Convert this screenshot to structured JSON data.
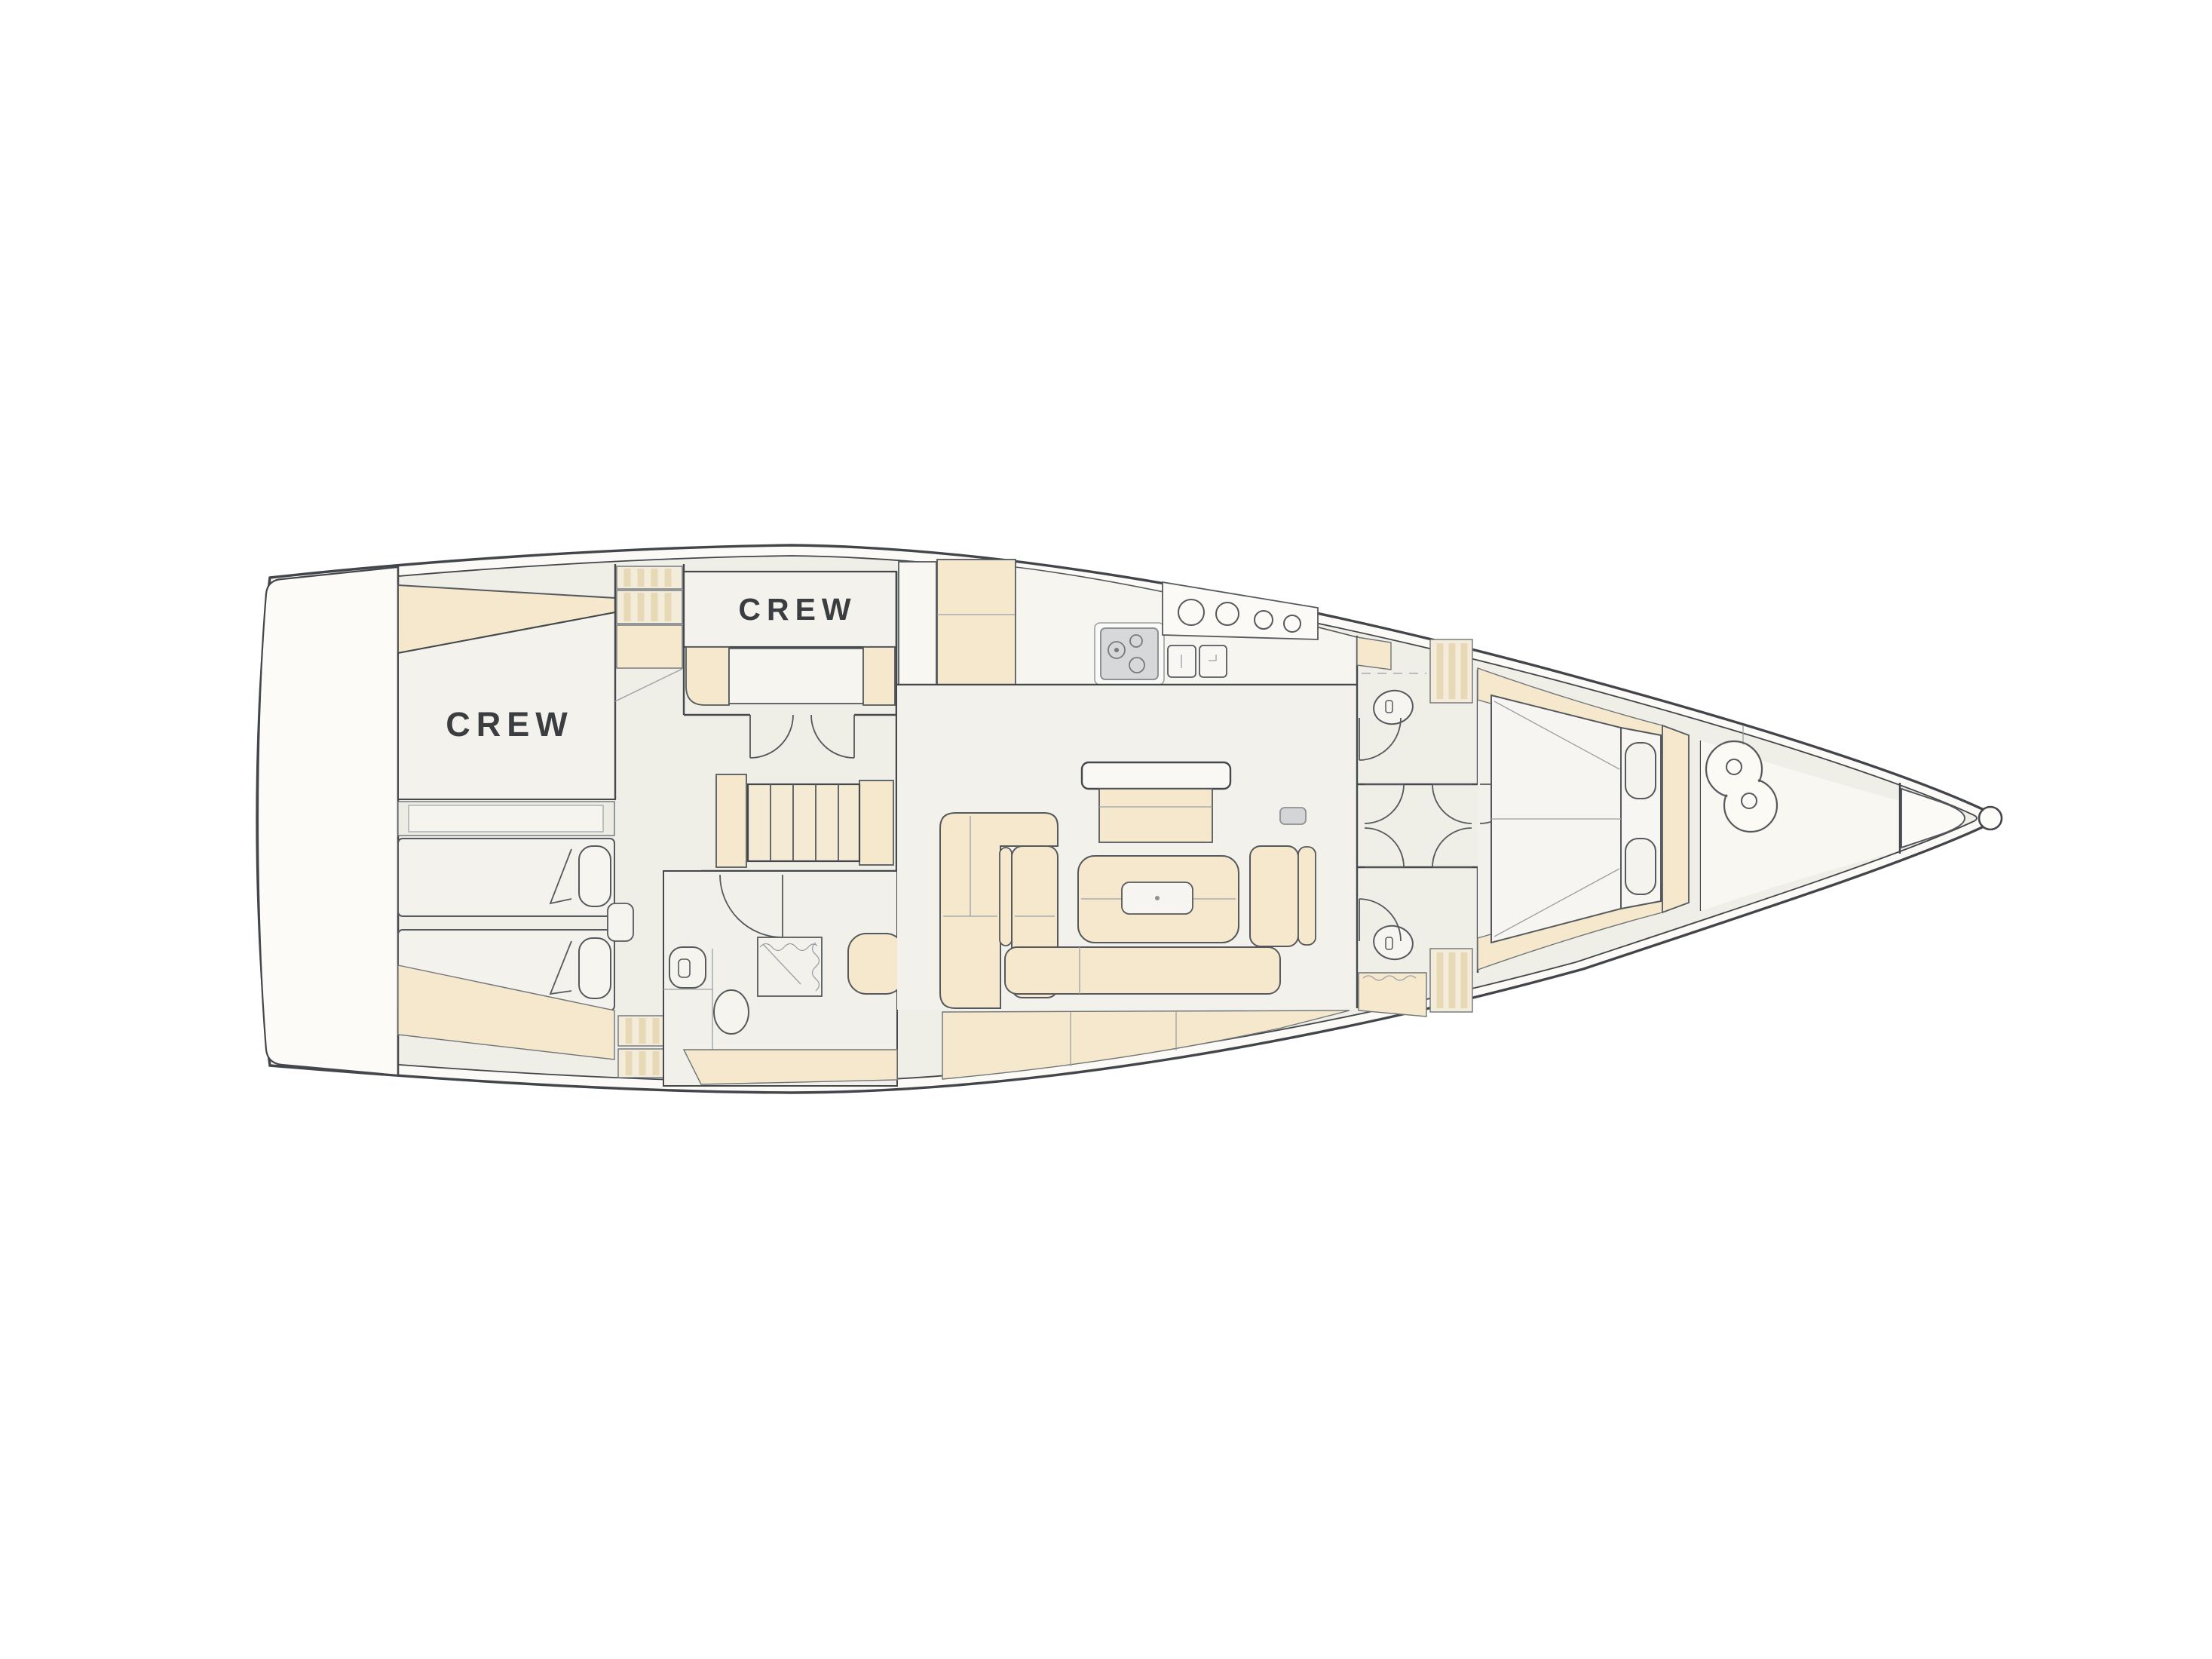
{
  "labels": {
    "aft_crew": "CREW",
    "mid_crew": "CREW"
  },
  "colors": {
    "background": "#ffffff",
    "hull_line": "#42464a",
    "deck_white": "#fbfaf6",
    "floor": "#efeee7",
    "room_light": "#f3f2ec",
    "white_surface": "#f7f6f1",
    "furniture_tan": "#f5e8cd",
    "hatch_background": "#f4ecda",
    "hatch_stripe": "#e7d8b6",
    "stove_gray": "#d7d8d9",
    "mast_gray": "#d4d5d6",
    "label_text": "#3b3e41"
  },
  "fixture_icons": [
    "transom-platform",
    "aft-crew-cabin",
    "twin-berths",
    "berth-pillows",
    "companionway-stairs",
    "aft-head-toilet",
    "aft-head-sink",
    "shower",
    "galley-cabinets",
    "galley-stove",
    "galley-sinks",
    "galley-portlights",
    "salon-table",
    "salon-sofa",
    "ottoman",
    "mast",
    "port-head-toilet",
    "starboard-head-toilet",
    "owner-v-berth",
    "sail-locker-windlass",
    "bow-eye"
  ]
}
